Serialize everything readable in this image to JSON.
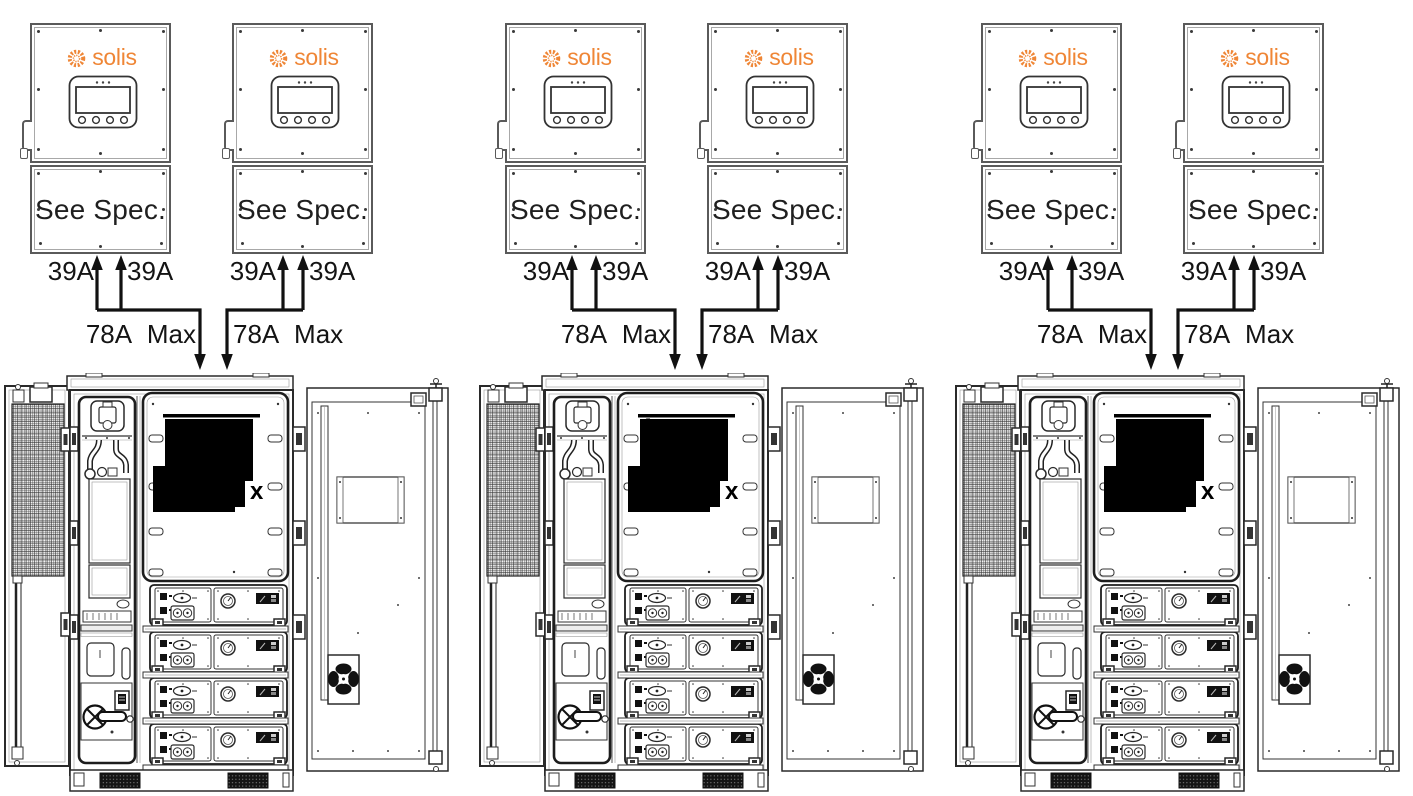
{
  "title": "Solis inverter pairs wired to battery storage cabinets",
  "colors": {
    "brand_orange": "#ef8636",
    "line_dark": "#141414",
    "redaction_black": "#000000"
  },
  "groups": [
    {
      "inverters": [
        {
          "brand": "solis",
          "panel_label": "See Spec.",
          "input_left": "39A",
          "input_right": "39A",
          "output_max": "78A Max"
        },
        {
          "brand": "solis",
          "panel_label": "See Spec.",
          "input_left": "39A",
          "input_right": "39A",
          "output_max": "78A Max"
        }
      ],
      "cabinet": {
        "redaction_leading": "",
        "redaction_trailing": "x"
      }
    },
    {
      "inverters": [
        {
          "brand": "solis",
          "panel_label": "See Spec.",
          "input_left": "39A",
          "input_right": "39A",
          "output_max": "78A Max"
        },
        {
          "brand": "solis",
          "panel_label": "See Spec.",
          "input_left": "39A",
          "input_right": "39A",
          "output_max": "78A Max"
        }
      ],
      "cabinet": {
        "redaction_leading": "1",
        "redaction_trailing": "x"
      }
    },
    {
      "inverters": [
        {
          "brand": "solis",
          "panel_label": "See Spec.",
          "input_left": "39A",
          "input_right": "39A",
          "output_max": "78A Max"
        },
        {
          "brand": "solis",
          "panel_label": "See Spec.",
          "input_left": "39A",
          "input_right": "39A",
          "output_max": "78A Max"
        }
      ],
      "cabinet": {
        "redaction_leading": "",
        "redaction_trailing": "x"
      }
    }
  ]
}
